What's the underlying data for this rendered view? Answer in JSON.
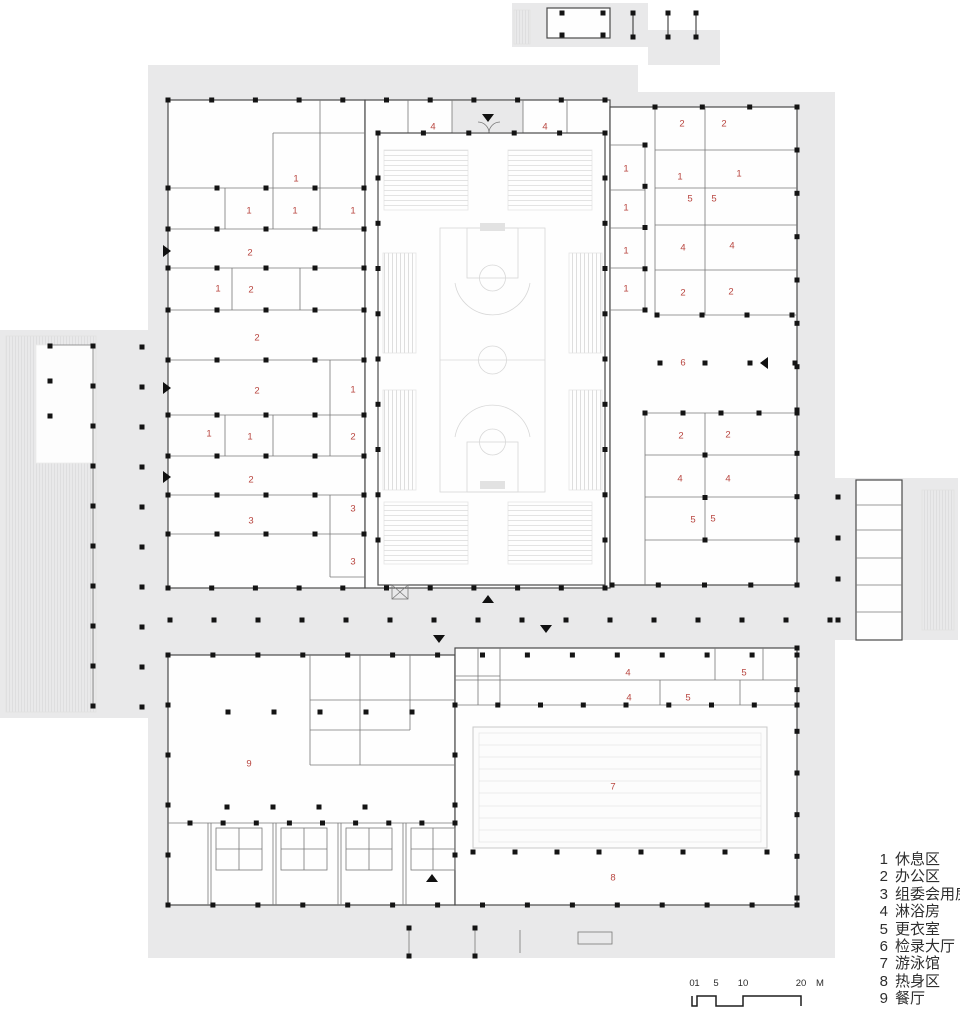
{
  "legend": {
    "items": [
      {
        "num": "1",
        "name": "休息区"
      },
      {
        "num": "2",
        "name": "办公区"
      },
      {
        "num": "3",
        "name": "组委会用房"
      },
      {
        "num": "4",
        "name": "淋浴房"
      },
      {
        "num": "5",
        "name": "更衣室"
      },
      {
        "num": "6",
        "name": "检录大厅"
      },
      {
        "num": "7",
        "name": "游泳馆"
      },
      {
        "num": "8",
        "name": "热身区"
      },
      {
        "num": "9",
        "name": "餐厅"
      }
    ]
  },
  "scale_bar": {
    "ticks": [
      "0",
      "1",
      "5",
      "10",
      "20"
    ],
    "unit": "M"
  },
  "room_labels": [
    {
      "n": "4",
      "x": 433,
      "y": 126
    },
    {
      "n": "4",
      "x": 545,
      "y": 126
    },
    {
      "n": "2",
      "x": 682,
      "y": 123
    },
    {
      "n": "2",
      "x": 724,
      "y": 123
    },
    {
      "n": "1",
      "x": 296,
      "y": 178
    },
    {
      "n": "1",
      "x": 249,
      "y": 210
    },
    {
      "n": "1",
      "x": 295,
      "y": 210
    },
    {
      "n": "1",
      "x": 353,
      "y": 210
    },
    {
      "n": "2",
      "x": 250,
      "y": 252
    },
    {
      "n": "1",
      "x": 218,
      "y": 288
    },
    {
      "n": "2",
      "x": 251,
      "y": 289
    },
    {
      "n": "2",
      "x": 257,
      "y": 337
    },
    {
      "n": "1",
      "x": 626,
      "y": 168
    },
    {
      "n": "1",
      "x": 626,
      "y": 207
    },
    {
      "n": "1",
      "x": 626,
      "y": 250
    },
    {
      "n": "1",
      "x": 626,
      "y": 288
    },
    {
      "n": "1",
      "x": 680,
      "y": 176
    },
    {
      "n": "1",
      "x": 739,
      "y": 173
    },
    {
      "n": "5",
      "x": 690,
      "y": 198
    },
    {
      "n": "5",
      "x": 714,
      "y": 198
    },
    {
      "n": "4",
      "x": 683,
      "y": 247
    },
    {
      "n": "4",
      "x": 732,
      "y": 245
    },
    {
      "n": "2",
      "x": 683,
      "y": 292
    },
    {
      "n": "2",
      "x": 731,
      "y": 291
    },
    {
      "n": "6",
      "x": 683,
      "y": 362
    },
    {
      "n": "2",
      "x": 257,
      "y": 390
    },
    {
      "n": "1",
      "x": 353,
      "y": 389
    },
    {
      "n": "1",
      "x": 209,
      "y": 433
    },
    {
      "n": "1",
      "x": 250,
      "y": 436
    },
    {
      "n": "2",
      "x": 353,
      "y": 436
    },
    {
      "n": "2",
      "x": 251,
      "y": 479
    },
    {
      "n": "3",
      "x": 251,
      "y": 520
    },
    {
      "n": "3",
      "x": 353,
      "y": 508
    },
    {
      "n": "3",
      "x": 353,
      "y": 561
    },
    {
      "n": "2",
      "x": 681,
      "y": 435
    },
    {
      "n": "2",
      "x": 728,
      "y": 434
    },
    {
      "n": "4",
      "x": 680,
      "y": 478
    },
    {
      "n": "4",
      "x": 728,
      "y": 478
    },
    {
      "n": "5",
      "x": 693,
      "y": 519
    },
    {
      "n": "5",
      "x": 713,
      "y": 518
    },
    {
      "n": "4",
      "x": 628,
      "y": 672
    },
    {
      "n": "4",
      "x": 629,
      "y": 697
    },
    {
      "n": "5",
      "x": 744,
      "y": 672
    },
    {
      "n": "5",
      "x": 688,
      "y": 697
    },
    {
      "n": "7",
      "x": 613,
      "y": 786
    },
    {
      "n": "8",
      "x": 613,
      "y": 877
    },
    {
      "n": "9",
      "x": 249,
      "y": 763
    }
  ],
  "arrows": [
    {
      "dir": "down",
      "x": 488,
      "y": 118
    },
    {
      "dir": "right",
      "x": 167,
      "y": 251
    },
    {
      "dir": "right",
      "x": 167,
      "y": 388
    },
    {
      "dir": "right",
      "x": 167,
      "y": 477
    },
    {
      "dir": "left",
      "x": 764,
      "y": 363
    },
    {
      "dir": "up",
      "x": 488,
      "y": 599
    },
    {
      "dir": "down",
      "x": 546,
      "y": 629
    },
    {
      "dir": "down",
      "x": 439,
      "y": 639
    },
    {
      "dir": "up",
      "x": 432,
      "y": 878
    }
  ],
  "colors": {
    "site_plate": "#e9e9ea",
    "building": "#fefefe",
    "wall": "#787878",
    "column": "#141414",
    "room_label": "#b8453f",
    "detail": "#d8d8d8",
    "text": "#2e2e2e"
  }
}
